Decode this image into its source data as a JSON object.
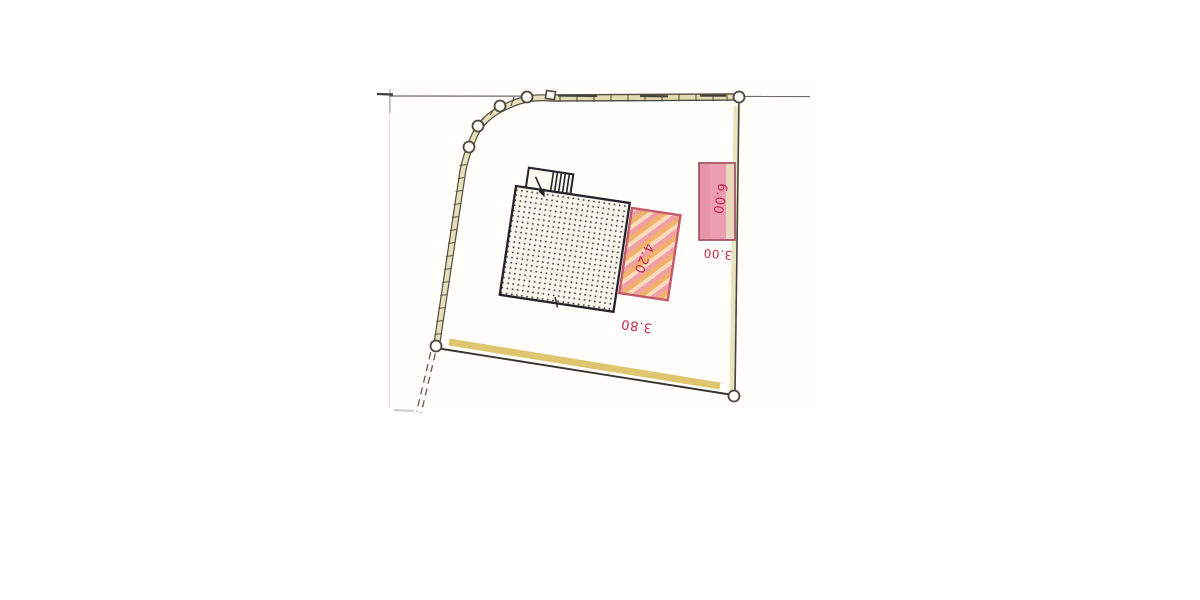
{
  "page": {
    "description": "Scanned hand-drawn cadastral site plan sketch of a parcel with main building, hatched extension and outbuilding",
    "background": "#ffffff"
  },
  "dimension_labels": {
    "extension_width": "4.20",
    "extension_depth": "3.80",
    "outbuilding_depth": "6.00",
    "outbuilding_width": "3.00"
  },
  "colors": {
    "dimension_text": "#c1294b",
    "ink": "#23232b",
    "band_tan": "#e2dbb2",
    "band_dark": "#4f4c42",
    "boundary_yellow": "#dfc56f",
    "pale_yellow": "#e9e3c0",
    "pink_fill": "#eb9db1",
    "pink_border": "#a55866",
    "hatch_pink": "#ef9aa4",
    "hatch_orange": "#f0aa58",
    "paper": "#fffefa"
  }
}
